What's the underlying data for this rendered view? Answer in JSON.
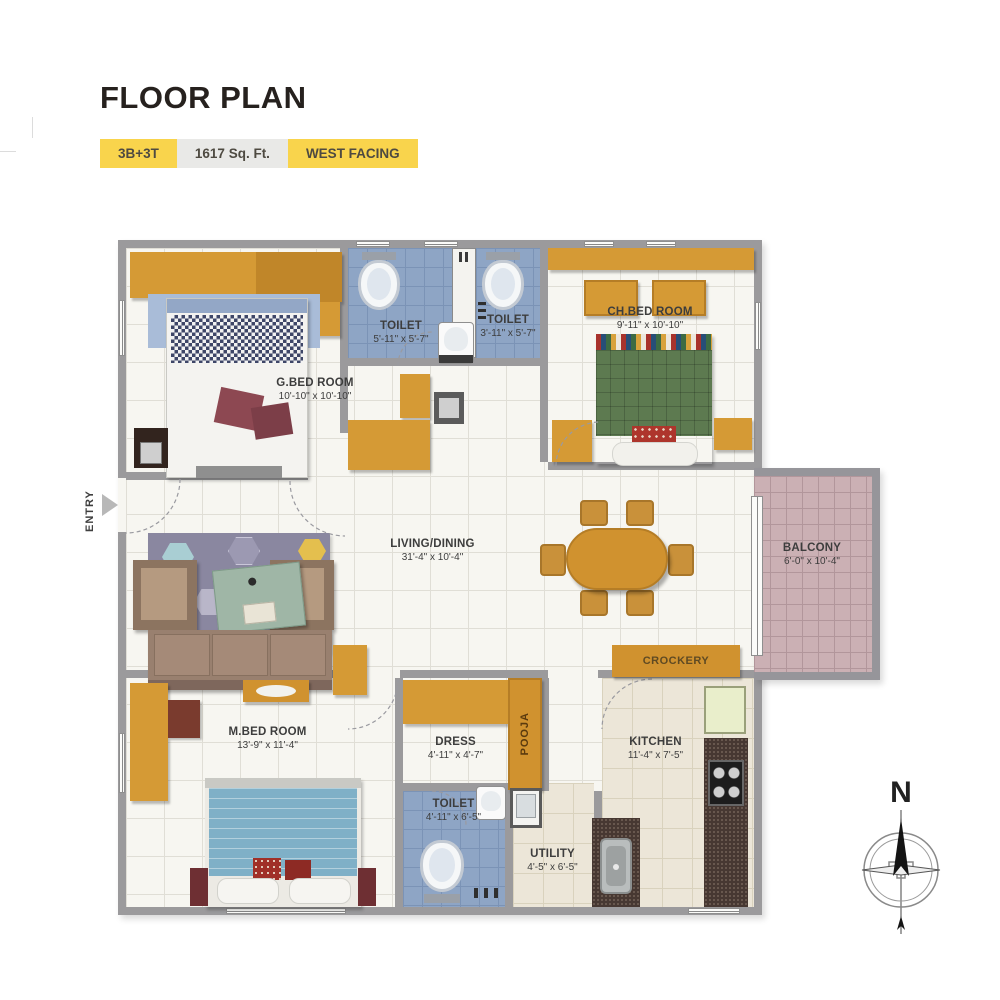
{
  "header": {
    "title": "FLOOR PLAN",
    "badges": [
      {
        "label": "3B+3T"
      },
      {
        "label": "1617 Sq. Ft."
      },
      {
        "label": "WEST FACING"
      }
    ]
  },
  "plan": {
    "rooms": {
      "gbed": {
        "name": "G.BED ROOM",
        "dims": "10'-10\" x 10'-10\""
      },
      "toilet_top_left": {
        "name": "TOILET",
        "dims": "5'-11\" x 5'-7\""
      },
      "toilet_top_right": {
        "name": "TOILET",
        "dims": "3'-11\" x 5'-7\""
      },
      "chbed": {
        "name": "CH.BED ROOM",
        "dims": "9'-11\" x 10'-10\""
      },
      "living": {
        "name": "LIVING/DINING",
        "dims": "31'-4\" x 10'-4\""
      },
      "balcony": {
        "name": "BALCONY",
        "dims": "6'-0\" x 10'-4\""
      },
      "mbed": {
        "name": "M.BED ROOM",
        "dims": "13'-9\" x 11'-4\""
      },
      "dress": {
        "name": "DRESS",
        "dims": "4'-11\" x 4'-7\""
      },
      "toilet_bottom": {
        "name": "TOILET",
        "dims": "4'-11\" x 6'-5\""
      },
      "utility": {
        "name": "UTILITY",
        "dims": "4'-5\" x 6'-5\""
      },
      "kitchen": {
        "name": "KITCHEN",
        "dims": "11'-4\" x 7'-5\""
      }
    },
    "annotations": {
      "pooja": "POOJA",
      "crockery": "CROCKERY",
      "entry": "ENTRY",
      "compass_north": "N"
    }
  },
  "colors": {
    "accent_yellow": "#f9d44c",
    "badge_gray": "#e9e9e7",
    "wall_gray": "#9b9a9c",
    "toilet_blue": "#8ea5c5",
    "balcony_pink": "#cbb0b4",
    "furniture_orange": "#d59a35",
    "title_text": "#26211e"
  }
}
